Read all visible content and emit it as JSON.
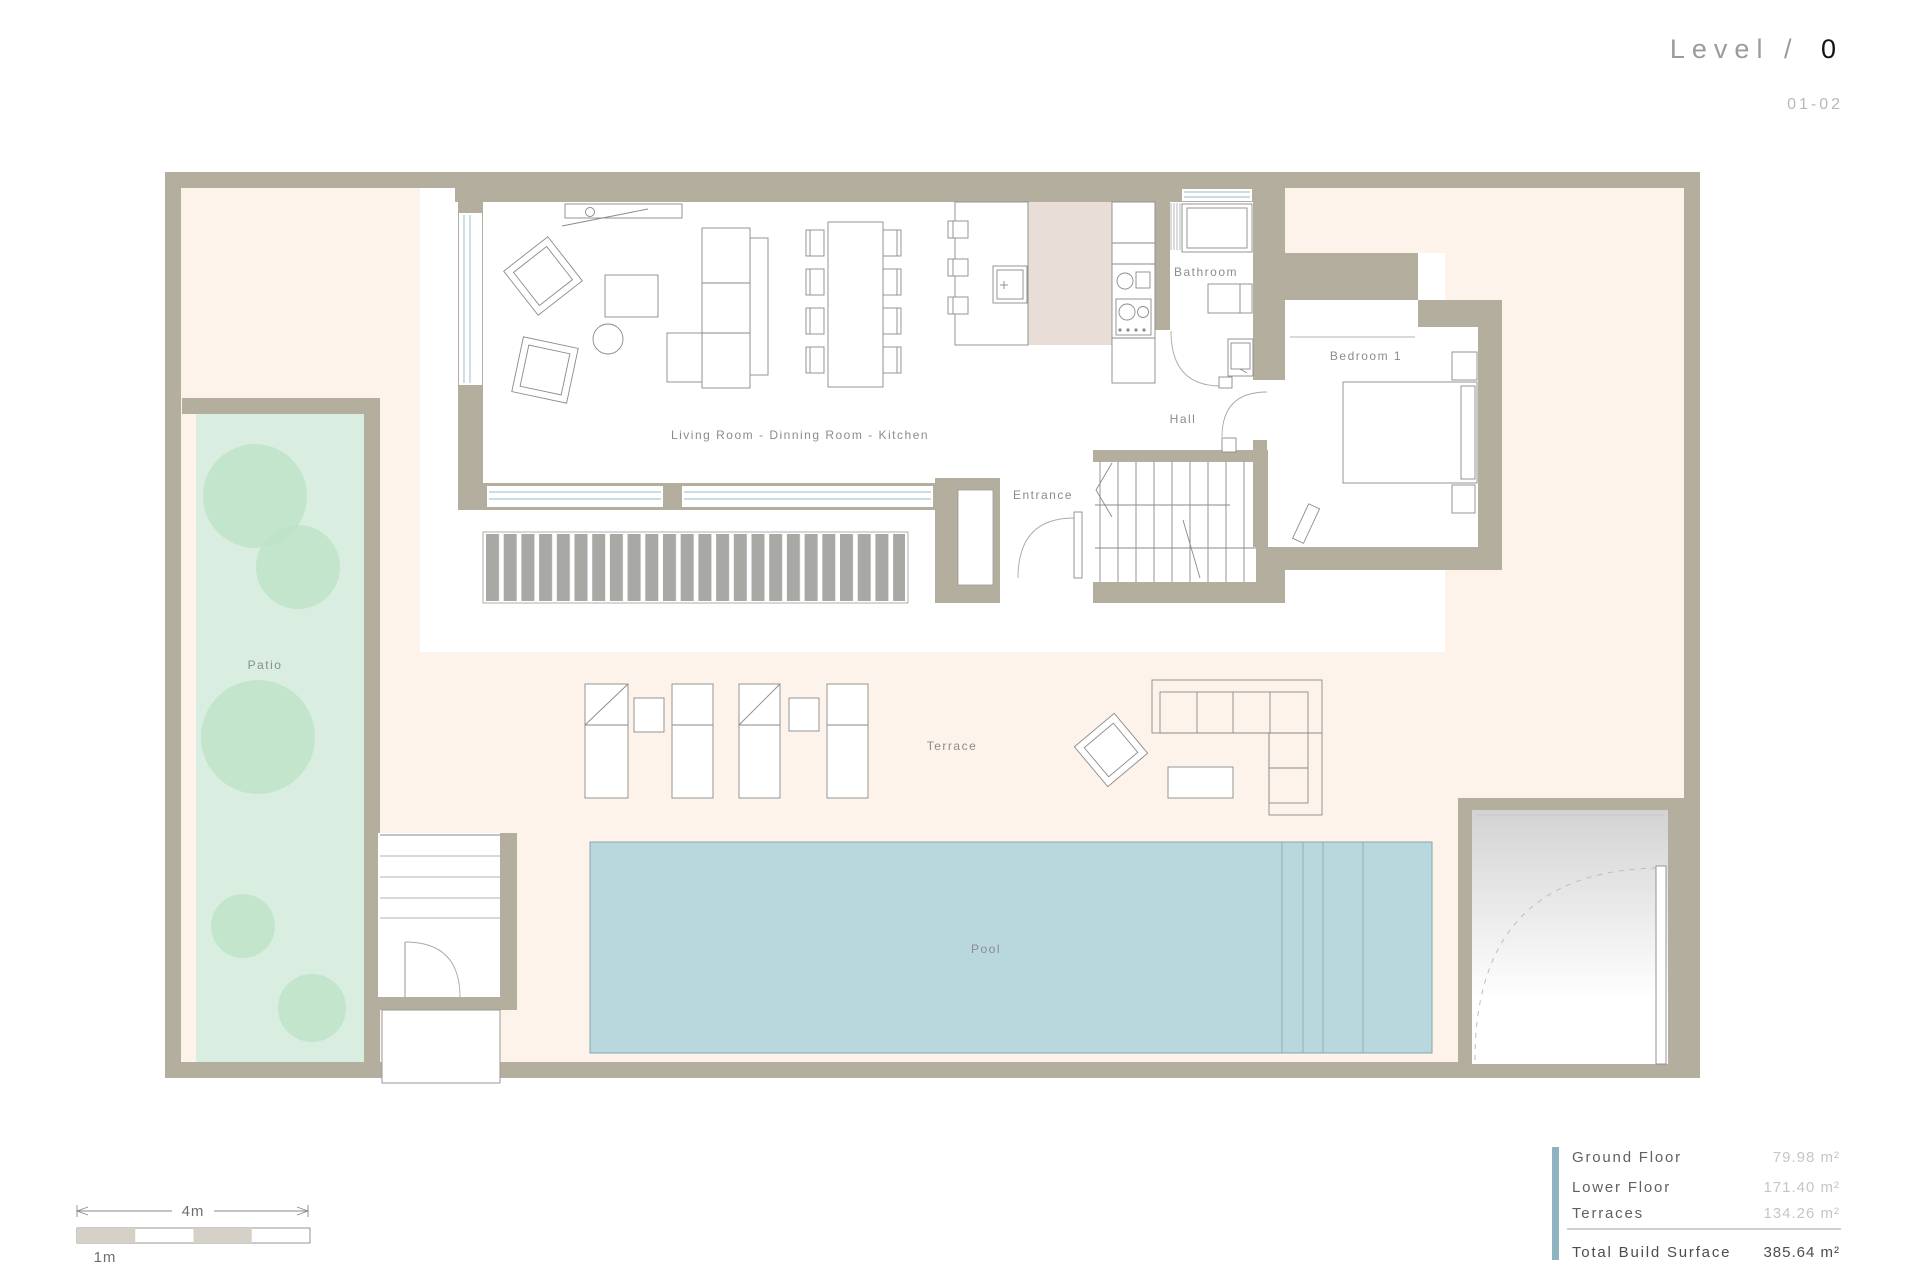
{
  "title": {
    "prefix": "Level /",
    "number": "0",
    "sheet_code": "01-02"
  },
  "rooms": {
    "living": "Living Room - Dinning Room - Kitchen",
    "bathroom": "Bathroom",
    "hall": "Hall",
    "bedroom": "Bedroom 1",
    "entrance": "Entrance",
    "patio": "Patio",
    "terrace": "Terrace",
    "pool": "Pool"
  },
  "areas": {
    "rows": [
      {
        "label": "Ground Floor",
        "value": "79.98 m²"
      },
      {
        "label": "Lower Floor",
        "value": "171.40 m²"
      },
      {
        "label": "Terraces",
        "value": "134.26 m²"
      }
    ],
    "total": {
      "label": "Total Build Surface",
      "value": "385.64 m²"
    }
  },
  "scale_bar": {
    "total_label": "4m",
    "unit_label": "1m"
  },
  "colors": {
    "wall": "#b4ae9f",
    "plot_ground": "#fdf3ea",
    "patio_green": "#d9eee0",
    "tree_green": "#bce2c7",
    "pool_blue": "#b8d8de",
    "kitchen_floor": "#e8ddd7",
    "deck_stripe": "#a8a8a4",
    "table_accent": "#8fb4c1",
    "title_gray": "#9b9b9b"
  }
}
